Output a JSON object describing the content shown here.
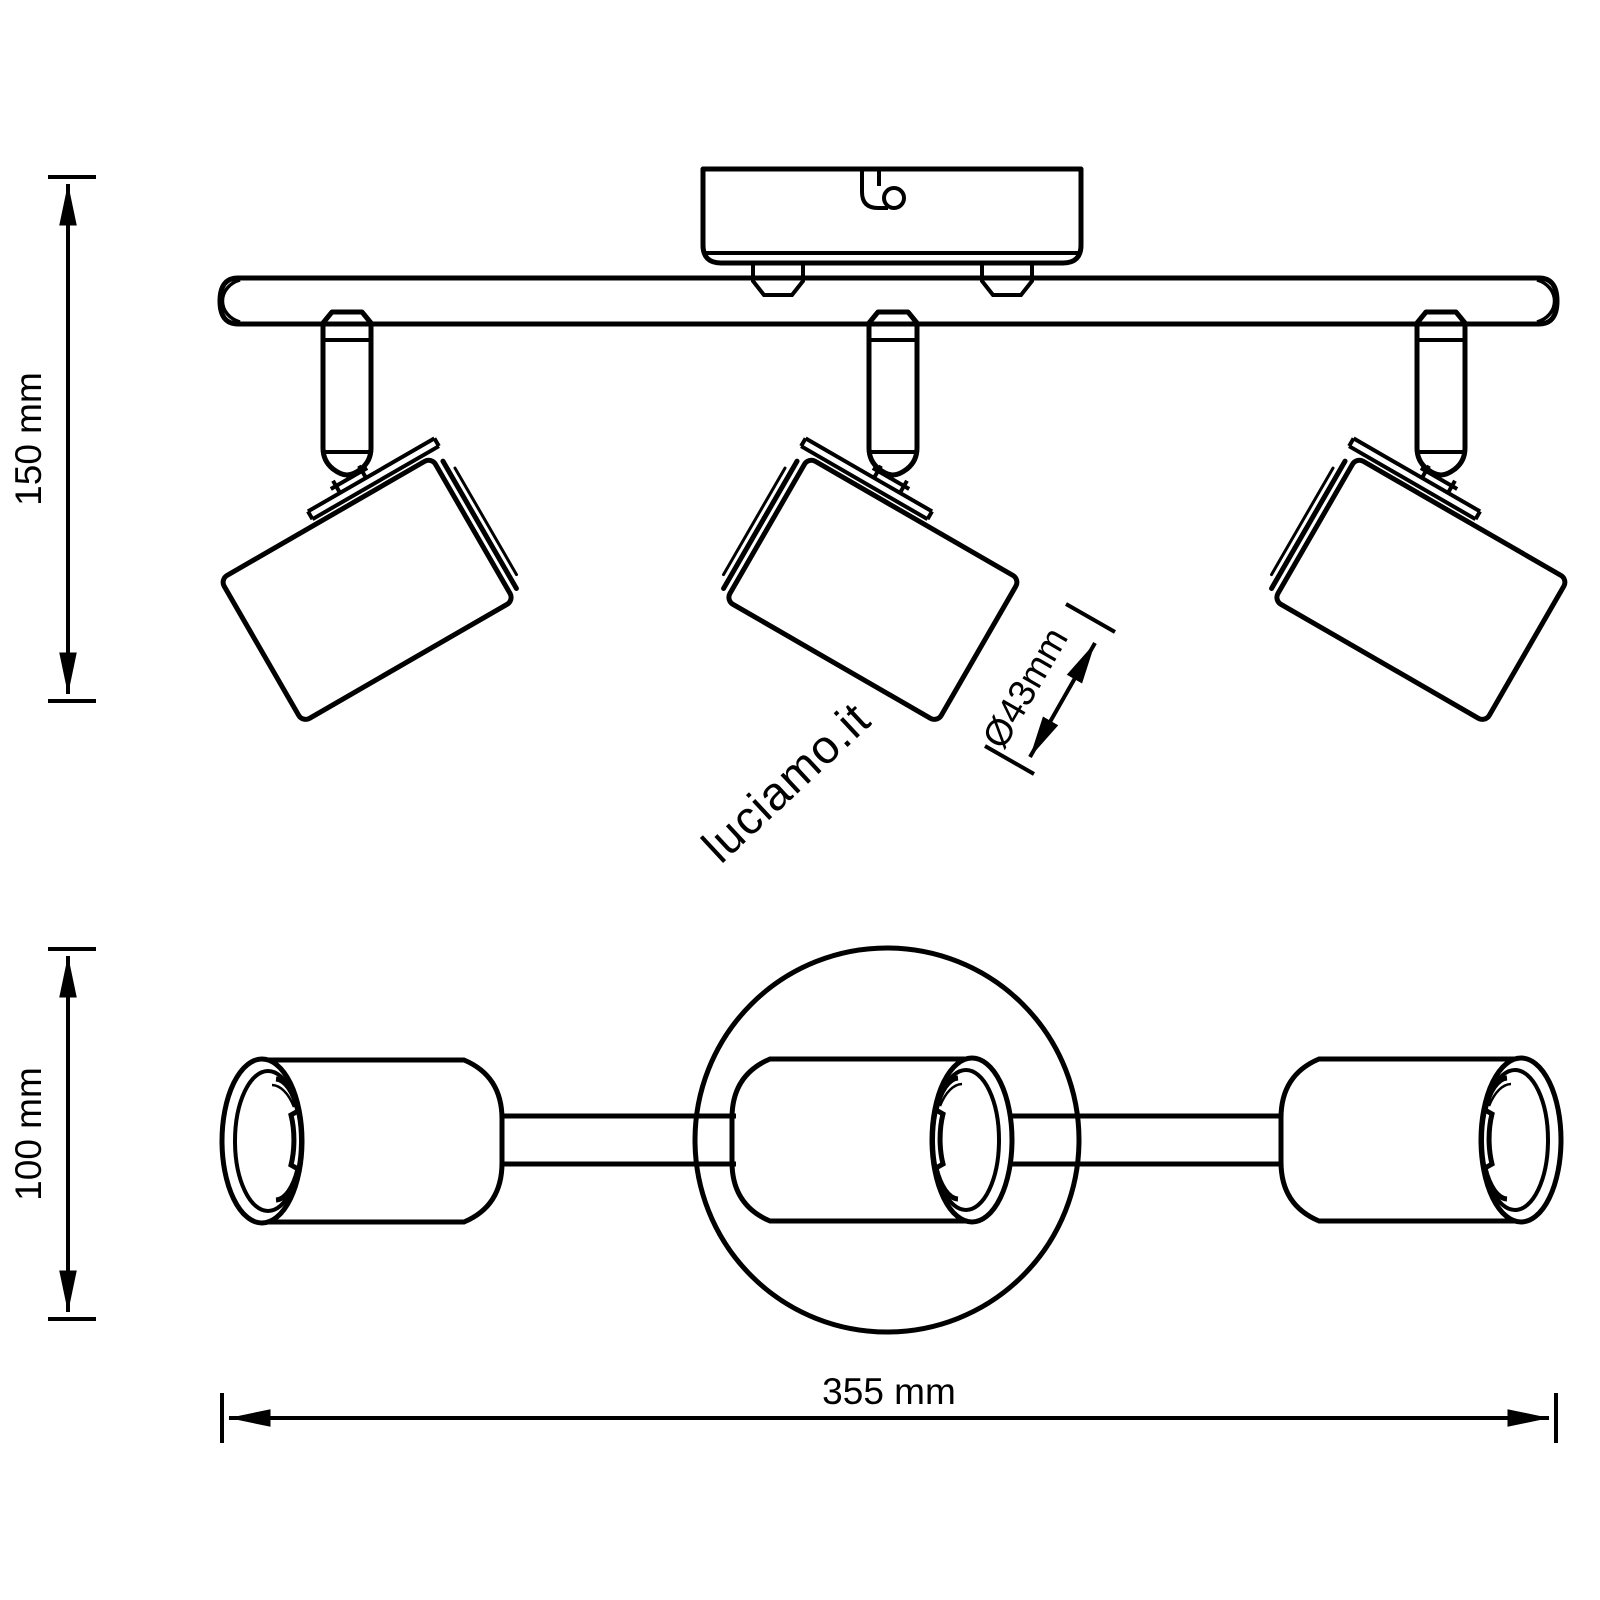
{
  "page": {
    "background": "#ffffff",
    "stroke_color": "#000000"
  },
  "watermark": {
    "text": "luciamo.it",
    "color": "#d2d2d2"
  },
  "drawing": {
    "dimensions": {
      "height_label": "150 mm",
      "depth_label": "100 mm",
      "width_label": "355 mm",
      "head_diameter_label": "Ø43mm"
    }
  }
}
